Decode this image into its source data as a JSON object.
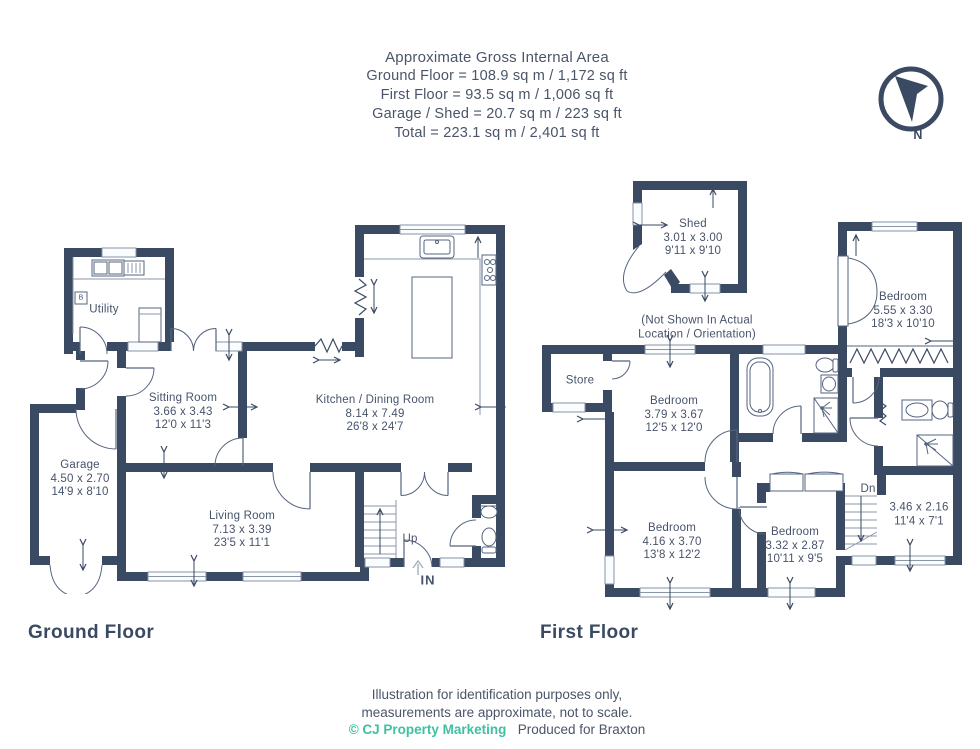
{
  "header": {
    "title": "Approximate Gross Internal Area",
    "areas": [
      "Ground Floor = 108.9 sq m / 1,172 sq ft",
      "First Floor = 93.5 sq m / 1,006 sq ft",
      "Garage / Shed = 20.7 sq m / 223 sq ft",
      "Total = 223.1 sq m / 2,401 sq ft"
    ],
    "compass_label": "N"
  },
  "ground_floor": {
    "title": "Ground Floor",
    "stairs_label": "Up",
    "entrance_label": "IN",
    "boiler_label": "B",
    "rooms": {
      "utility": {
        "name": "Utility"
      },
      "sitting_room": {
        "name": "Sitting Room",
        "metric": "3.66 x 3.43",
        "imperial": "12'0 x 11'3"
      },
      "kitchen_dining": {
        "name": "Kitchen / Dining Room",
        "metric": "8.14 x 7.49",
        "imperial": "26'8 x 24'7"
      },
      "garage": {
        "name": "Garage",
        "metric": "4.50 x 2.70",
        "imperial": "14'9 x 8'10"
      },
      "living_room": {
        "name": "Living Room",
        "metric": "7.13 x 3.39",
        "imperial": "23'5 x 11'1"
      }
    }
  },
  "first_floor": {
    "title": "First Floor",
    "stairs_label": "Dn",
    "shed_note_line1": "(Not Shown In Actual",
    "shed_note_line2": "Location / Orientation)",
    "rooms": {
      "shed": {
        "name": "Shed",
        "metric": "3.01 x 3.00",
        "imperial": "9'11 x 9'10"
      },
      "store": {
        "name": "Store"
      },
      "bedroom_1": {
        "name": "Bedroom",
        "metric": "5.55 x 3.30",
        "imperial": "18'3 x 10'10"
      },
      "bedroom_2": {
        "name": "Bedroom",
        "metric": "3.79 x 3.67",
        "imperial": "12'5 x 12'0"
      },
      "bedroom_3": {
        "name": "Bedroom",
        "metric": "4.16 x 3.70",
        "imperial": "13'8 x 12'2"
      },
      "bedroom_4": {
        "name": "Bedroom",
        "metric": "3.32 x 2.87",
        "imperial": "10'11 x 9'5"
      },
      "landing_room": {
        "metric": "3.46 x 2.16",
        "imperial": "11'4 x 7'1"
      }
    }
  },
  "footer": {
    "line1": "Illustration for identification purposes only,",
    "line2": "measurements are approximate, not to scale.",
    "credit": "© CJ Property Marketing",
    "produced": "Produced for Braxton"
  },
  "colors": {
    "wall": "#3b4a63",
    "text": "#4a5568",
    "accent": "#3fc0a1"
  }
}
